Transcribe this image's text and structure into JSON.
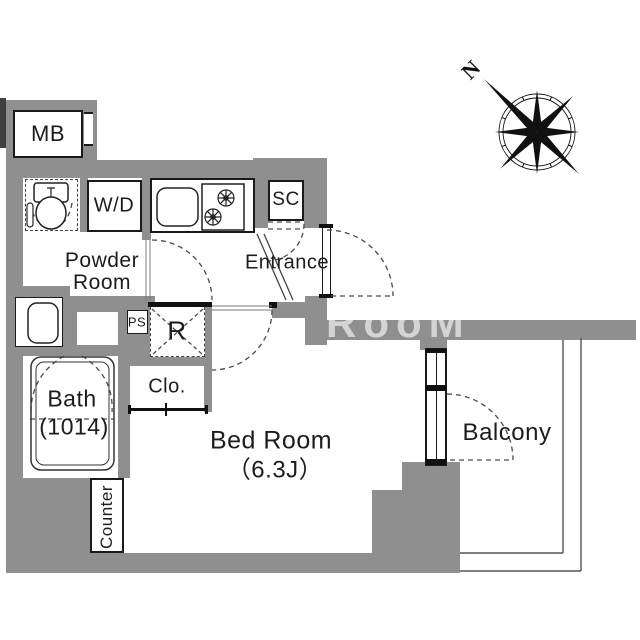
{
  "labels": {
    "mb": "MB",
    "wd": "W/D",
    "powder_line1": "Powder",
    "powder_line2": "Room",
    "sc": "SC",
    "entrance": "Entrance",
    "ps": "PS",
    "refrigerator": "R",
    "closet": "Clo.",
    "bath_line1": "Bath",
    "bath_line2": "(1014)",
    "bedroom_line1": "Bed Room",
    "bedroom_line2": "（6.3J）",
    "balcony": "Balcony",
    "counter": "Counter"
  },
  "compass": {
    "north_label": "N"
  },
  "watermark_text": "RooM",
  "colors": {
    "wall": "#8f8f8f",
    "dark_strip": "#3f3f3f",
    "outline": "#1a1a1a",
    "dashed_line": "#4a4a4a"
  }
}
